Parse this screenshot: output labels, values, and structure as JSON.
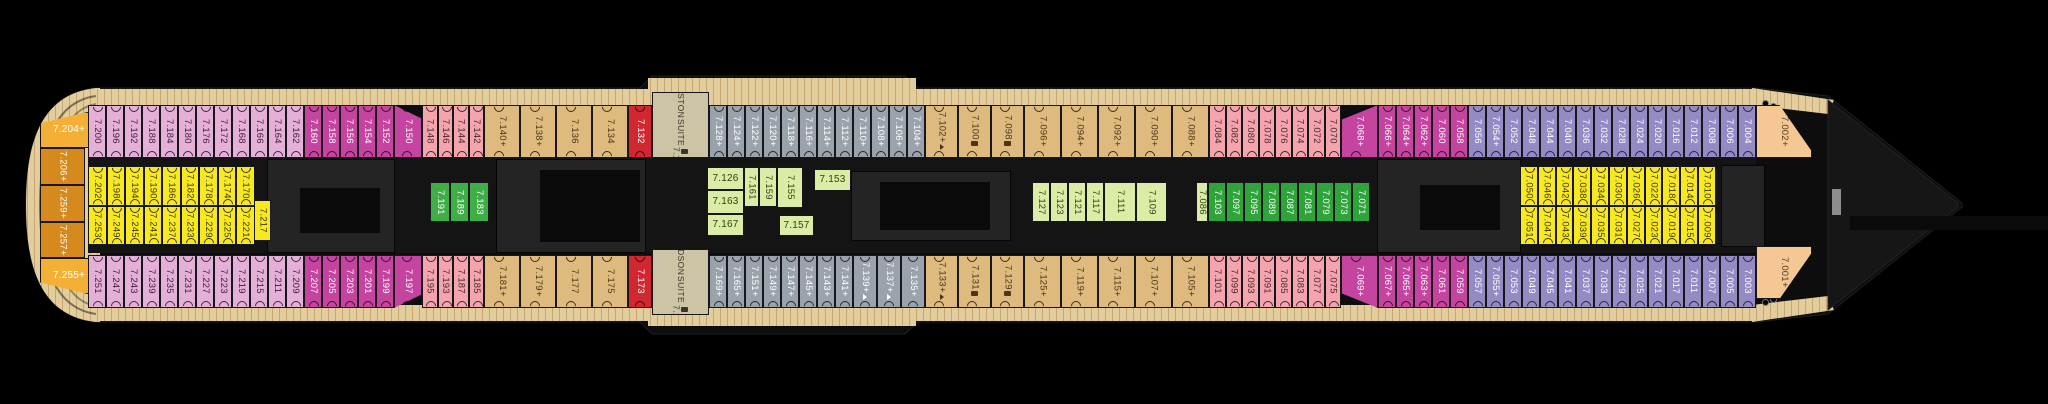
{
  "deck_plan": {
    "deck_number_prefix": "7",
    "suites": [
      "BOSTON SUITE 7.130",
      "HUDSON SUITE 7.171"
    ],
    "icon_legend_names": {
      "p": "plus",
      "s": "sofa-icon",
      "pa": "plus-accessible-icon"
    }
  },
  "colors": {
    "pink": "#e4b0d7",
    "magenta": "#c5449f",
    "salmon": "#f3a4ac",
    "tan": "#dfba7e",
    "red": "#d02730",
    "gray": "#9aa2ab",
    "suite": "#cdc4a6",
    "lightgreen": "#daeca6",
    "green": "#3fae47",
    "darkgreen": "#2ea43b",
    "purple": "#948bc5",
    "yellow": "#f7e821",
    "amber": "#f3b034",
    "orange": "#d68a1d",
    "bowtan": "#f5c795",
    "deck": "#e3cd9c"
  },
  "sections": [
    {
      "c": "amber",
      "x": 40,
      "y": 112,
      "w": 58,
      "h": 36,
      "o": "h",
      "clip": "sternT",
      "cabins": [
        [
          "7.204",
          "p"
        ]
      ]
    },
    {
      "c": "orange",
      "x": 40,
      "y": 148,
      "w": 45,
      "h": 37,
      "o": "v",
      "cabins": [
        [
          "7.206",
          "p"
        ]
      ]
    },
    {
      "c": "orange",
      "x": 40,
      "y": 185,
      "w": 45,
      "h": 37,
      "o": "v",
      "cabins": [
        [
          "7.259",
          "p"
        ]
      ]
    },
    {
      "c": "orange",
      "x": 40,
      "y": 222,
      "w": 45,
      "h": 36,
      "o": "v",
      "cabins": [
        [
          "7.257",
          "p"
        ]
      ]
    },
    {
      "c": "amber",
      "x": 40,
      "y": 258,
      "w": 58,
      "h": 36,
      "o": "h",
      "clip": "sternB",
      "cabins": [
        [
          "7.255",
          "p"
        ]
      ]
    },
    {
      "c": "pink",
      "r": "t",
      "x": 88,
      "w": 18,
      "cabins": [
        [
          "7.200"
        ],
        [
          "7.196"
        ],
        [
          "7.192"
        ],
        [
          "7.188"
        ],
        [
          "7.184"
        ],
        [
          "7.180"
        ],
        [
          "7.176"
        ],
        [
          "7.172"
        ],
        [
          "7.168"
        ],
        [
          "7.166"
        ],
        [
          "7.164"
        ],
        [
          "7.162"
        ]
      ]
    },
    {
      "c": "magenta",
      "r": "t",
      "x": 304,
      "w": 18,
      "cabins": [
        [
          "7.160"
        ],
        [
          "7.158"
        ],
        [
          "7.156"
        ],
        [
          "7.154"
        ],
        [
          "7.152"
        ]
      ]
    },
    {
      "c": "magenta",
      "r": "t",
      "x": 394,
      "w": 28,
      "clip": "slantTR",
      "cabins": [
        [
          "7.150"
        ]
      ]
    },
    {
      "c": "salmon",
      "r": "t",
      "x": 422,
      "w": 15.5,
      "cabins": [
        [
          "7.148"
        ],
        [
          "7.146"
        ],
        [
          "7.144"
        ],
        [
          "7.142"
        ]
      ]
    },
    {
      "c": "tan",
      "r": "t",
      "x": 484,
      "w": 36,
      "cabins": [
        [
          "7.140",
          "p"
        ],
        [
          "7.138",
          "p"
        ],
        [
          "7.136"
        ],
        [
          "7.134"
        ]
      ]
    },
    {
      "c": "red",
      "r": "t",
      "x": 628,
      "w": 24,
      "cabins": [
        [
          "7.132"
        ]
      ]
    },
    {
      "c": "suite",
      "x": 652,
      "y": 92,
      "w": 57,
      "h": 66,
      "o": "suite",
      "name": [
        "BOSTON",
        "SUITE"
      ],
      "cabins": [
        [
          "7.130",
          "s"
        ]
      ]
    },
    {
      "c": "gray",
      "r": "t",
      "x": 709,
      "w": 18,
      "cabins": [
        [
          "7.128",
          "p"
        ],
        [
          "7.124",
          "p"
        ],
        [
          "7.122",
          "p"
        ],
        [
          "7.120",
          "p"
        ],
        [
          "7.118",
          "p"
        ],
        [
          "7.116",
          "p"
        ],
        [
          "7.114",
          "p"
        ],
        [
          "7.112",
          "p"
        ],
        [
          "7.110",
          "p"
        ],
        [
          "7.108",
          "p"
        ],
        [
          "7.106",
          "p"
        ],
        [
          "7.104",
          "p"
        ]
      ]
    },
    {
      "c": "tan",
      "r": "t",
      "x": 925,
      "w": 33,
      "cabins": [
        [
          "7.102",
          "pa"
        ],
        [
          "7.100",
          "s"
        ],
        [
          "7.098",
          "s"
        ]
      ]
    },
    {
      "c": "tan",
      "r": "t",
      "x": 1024,
      "w": 37,
      "cabins": [
        [
          "7.096",
          "p"
        ],
        [
          "7.094",
          "p"
        ],
        [
          "7.092",
          "p"
        ],
        [
          "7.090",
          "p"
        ],
        [
          "7.088",
          "p"
        ]
      ]
    },
    {
      "c": "salmon",
      "r": "t",
      "x": 1209,
      "w": 16.5,
      "cabins": [
        [
          "7.084"
        ],
        [
          "7.082"
        ],
        [
          "7.080"
        ],
        [
          "7.078"
        ],
        [
          "7.076"
        ],
        [
          "7.074"
        ],
        [
          "7.072"
        ],
        [
          "7.070"
        ]
      ]
    },
    {
      "c": "magenta",
      "r": "t",
      "x": 1341,
      "w": 37,
      "clip": "slantTL",
      "cabins": [
        [
          "7.068",
          "p"
        ]
      ]
    },
    {
      "c": "magenta",
      "r": "t",
      "x": 1378,
      "w": 18,
      "cabins": [
        [
          "7.066",
          "p"
        ],
        [
          "7.064",
          "p"
        ],
        [
          "7.062",
          "p"
        ],
        [
          "7.060"
        ],
        [
          "7.058"
        ]
      ]
    },
    {
      "c": "purple",
      "r": "t",
      "x": 1468,
      "w": 18,
      "cabins": [
        [
          "7.056"
        ],
        [
          "7.054",
          "p"
        ],
        [
          "7.052"
        ],
        [
          "7.048"
        ],
        [
          "7.044"
        ],
        [
          "7.040"
        ],
        [
          "7.036"
        ],
        [
          "7.032"
        ],
        [
          "7.028"
        ],
        [
          "7.024"
        ],
        [
          "7.020"
        ],
        [
          "7.016"
        ],
        [
          "7.012"
        ],
        [
          "7.008"
        ],
        [
          "7.006"
        ],
        [
          "7.004"
        ]
      ]
    },
    {
      "c": "bowtan",
      "x": 1756,
      "y": 105,
      "w": 56,
      "h": 53,
      "o": "v",
      "clip": "bowT",
      "cabins": [
        [
          "7.002",
          "p"
        ]
      ]
    },
    {
      "c": "pink",
      "r": "b",
      "x": 88,
      "w": 18,
      "cabins": [
        [
          "7.251"
        ],
        [
          "7.247"
        ],
        [
          "7.243"
        ],
        [
          "7.239"
        ],
        [
          "7.235"
        ],
        [
          "7.231"
        ],
        [
          "7.227"
        ],
        [
          "7.223"
        ],
        [
          "7.219"
        ],
        [
          "7.215"
        ],
        [
          "7.211"
        ],
        [
          "7.209"
        ]
      ]
    },
    {
      "c": "magenta",
      "r": "b",
      "x": 304,
      "w": 18,
      "cabins": [
        [
          "7.207"
        ],
        [
          "7.205"
        ],
        [
          "7.203"
        ],
        [
          "7.201"
        ],
        [
          "7.199"
        ]
      ]
    },
    {
      "c": "magenta",
      "r": "b",
      "x": 394,
      "w": 28,
      "clip": "slantBR",
      "cabins": [
        [
          "7.197"
        ]
      ]
    },
    {
      "c": "salmon",
      "r": "b",
      "x": 422,
      "w": 15.5,
      "cabins": [
        [
          "7.195"
        ],
        [
          "7.193"
        ],
        [
          "7.187"
        ],
        [
          "7.185"
        ]
      ]
    },
    {
      "c": "tan",
      "r": "b",
      "x": 484,
      "w": 36,
      "cabins": [
        [
          "7.181",
          "p"
        ],
        [
          "7.179",
          "p"
        ],
        [
          "7.177"
        ],
        [
          "7.175"
        ]
      ]
    },
    {
      "c": "red",
      "r": "b",
      "x": 628,
      "w": 24,
      "cabins": [
        [
          "7.173"
        ]
      ]
    },
    {
      "c": "suite",
      "x": 652,
      "y": 249,
      "w": 57,
      "h": 66,
      "o": "suite",
      "name": [
        "HUDSON",
        "SUITE"
      ],
      "cabins": [
        [
          "7.171",
          "s"
        ]
      ]
    },
    {
      "c": "gray",
      "r": "b",
      "x": 709,
      "w": 18,
      "cabins": [
        [
          "7.169",
          "p"
        ],
        [
          "7.165",
          "p"
        ],
        [
          "7.151",
          "p"
        ],
        [
          "7.149",
          "p"
        ],
        [
          "7.147",
          "p"
        ],
        [
          "7.145",
          "p"
        ],
        [
          "7.143",
          "p"
        ],
        [
          "7.141",
          "p"
        ],
        [
          "7.139",
          "pa",
          24
        ],
        [
          "7.137",
          "pa",
          24
        ],
        [
          "7.135",
          "p",
          24
        ]
      ]
    },
    {
      "c": "tan",
      "r": "b",
      "x": 925,
      "w": 33,
      "cabins": [
        [
          "7.133",
          "pa"
        ],
        [
          "7.131",
          "s"
        ],
        [
          "7.129",
          "s"
        ]
      ]
    },
    {
      "c": "tan",
      "r": "b",
      "x": 1024,
      "w": 37,
      "cabins": [
        [
          "7.125",
          "p"
        ],
        [
          "7.119",
          "p"
        ],
        [
          "7.115",
          "p"
        ],
        [
          "7.107",
          "p"
        ],
        [
          "7.105",
          "p"
        ]
      ]
    },
    {
      "c": "salmon",
      "r": "b",
      "x": 1209,
      "w": 16.5,
      "cabins": [
        [
          "7.101"
        ],
        [
          "7.099"
        ],
        [
          "7.093"
        ],
        [
          "7.091"
        ],
        [
          "7.085"
        ],
        [
          "7.083"
        ],
        [
          "7.077"
        ],
        [
          "7.075"
        ]
      ]
    },
    {
      "c": "magenta",
      "r": "b",
      "x": 1341,
      "w": 37,
      "clip": "slantBL",
      "cabins": [
        [
          "7.069",
          "p"
        ]
      ]
    },
    {
      "c": "magenta",
      "r": "b",
      "x": 1378,
      "w": 18,
      "cabins": [
        [
          "7.067",
          "p"
        ],
        [
          "7.065",
          "p"
        ],
        [
          "7.063",
          "p"
        ],
        [
          "7.061"
        ],
        [
          "7.059"
        ]
      ]
    },
    {
      "c": "purple",
      "r": "b",
      "x": 1468,
      "w": 18,
      "cabins": [
        [
          "7.057"
        ],
        [
          "7.055",
          "p"
        ],
        [
          "7.053"
        ],
        [
          "7.049"
        ],
        [
          "7.045"
        ],
        [
          "7.041"
        ],
        [
          "7.037"
        ],
        [
          "7.033"
        ],
        [
          "7.029"
        ],
        [
          "7.025"
        ],
        [
          "7.021"
        ],
        [
          "7.017"
        ],
        [
          "7.011"
        ],
        [
          "7.007"
        ],
        [
          "7.005"
        ],
        [
          "7.003"
        ]
      ]
    },
    {
      "c": "bowtan",
      "x": 1756,
      "y": 246,
      "w": 56,
      "h": 53,
      "o": "v",
      "clip": "bowB",
      "cabins": [
        [
          "7.001",
          "p"
        ]
      ]
    },
    {
      "c": "yellow",
      "r": "mt",
      "x": 88,
      "w": 18.5,
      "cabins": [
        [
          "7.202"
        ],
        [
          "7.198"
        ],
        [
          "7.194"
        ],
        [
          "7.190"
        ],
        [
          "7.186"
        ],
        [
          "7.182"
        ],
        [
          "7.178"
        ],
        [
          "7.174"
        ],
        [
          "7.170"
        ]
      ]
    },
    {
      "c": "yellow",
      "r": "mb",
      "x": 88,
      "w": 18.5,
      "cabins": [
        [
          "7.253"
        ],
        [
          "7.249"
        ],
        [
          "7.245"
        ],
        [
          "7.241"
        ],
        [
          "7.237"
        ],
        [
          "7.233"
        ],
        [
          "7.229"
        ],
        [
          "7.225"
        ],
        [
          "7.221"
        ]
      ]
    },
    {
      "c": "yellow",
      "x": 254,
      "y": 200,
      "w": 17,
      "h": 41,
      "o": "v",
      "cabins": [
        [
          "7.217"
        ]
      ]
    },
    {
      "c": "green",
      "x": 430,
      "y": 182,
      "w": 20,
      "h": 40,
      "o": "v",
      "cabins": [
        [
          "7.191",
          null,
          20
        ],
        [
          "7.189",
          null,
          19
        ],
        [
          "7.183",
          null,
          20
        ]
      ]
    },
    {
      "c": "lightgreen",
      "x": 707,
      "y": 167,
      "w": 37,
      "h": 23,
      "o": "h",
      "cabins": [
        [
          "7.126"
        ]
      ]
    },
    {
      "c": "lightgreen",
      "x": 707,
      "y": 190,
      "w": 37,
      "h": 24,
      "o": "h",
      "cabins": [
        [
          "7.163"
        ]
      ]
    },
    {
      "c": "lightgreen",
      "x": 707,
      "y": 214,
      "w": 37,
      "h": 22,
      "o": "h",
      "cabins": [
        [
          "7.167"
        ]
      ]
    },
    {
      "c": "lightgreen",
      "x": 744,
      "y": 167,
      "w": 15,
      "h": 40,
      "o": "v",
      "cabins": [
        [
          "7.161"
        ]
      ]
    },
    {
      "c": "lightgreen",
      "x": 759,
      "y": 167,
      "w": 18,
      "h": 40,
      "o": "v",
      "cabins": [
        [
          "7.159"
        ]
      ]
    },
    {
      "c": "lightgreen",
      "x": 777,
      "y": 167,
      "w": 26,
      "h": 41,
      "o": "v",
      "cabins": [
        [
          "7.155"
        ]
      ]
    },
    {
      "c": "lightgreen",
      "x": 814,
      "y": 169,
      "w": 37,
      "h": 22,
      "o": "h",
      "cabins": [
        [
          "7.153"
        ]
      ]
    },
    {
      "c": "lightgreen",
      "x": 779,
      "y": 215,
      "w": 35,
      "h": 21,
      "o": "h",
      "cabins": [
        [
          "7.157"
        ]
      ]
    },
    {
      "c": "lightgreen",
      "x": 1032,
      "y": 182,
      "w": 18,
      "h": 40,
      "o": "v",
      "cabins": [
        [
          "7.127"
        ],
        [
          "7.123"
        ],
        [
          "7.121"
        ],
        [
          "7.117"
        ],
        [
          "7.111",
          null,
          32
        ],
        [
          "7.109",
          null,
          31
        ]
      ]
    },
    {
      "c": "lightgreen",
      "x": 1196,
      "y": 182,
      "w": 12,
      "h": 40,
      "o": "v",
      "cabins": [
        [
          "7.086"
        ]
      ]
    },
    {
      "c": "darkgreen",
      "x": 1208,
      "y": 182,
      "w": 18,
      "h": 40,
      "o": "v",
      "cabins": [
        [
          "7.103"
        ],
        [
          "7.097"
        ],
        [
          "7.095"
        ],
        [
          "7.089"
        ],
        [
          "7.087"
        ],
        [
          "7.081"
        ],
        [
          "7.079"
        ],
        [
          "7.073"
        ],
        [
          "7.071"
        ]
      ]
    },
    {
      "c": "yellow",
      "r": "mt",
      "x": 1520,
      "w": 17.8,
      "cabins": [
        [
          "7.050"
        ],
        [
          "7.046"
        ],
        [
          "7.042"
        ],
        [
          "7.038"
        ],
        [
          "7.034"
        ],
        [
          "7.030"
        ],
        [
          "7.026"
        ],
        [
          "7.022"
        ],
        [
          "7.018"
        ],
        [
          "7.014"
        ],
        [
          "7.010"
        ]
      ]
    },
    {
      "c": "yellow",
      "r": "mb",
      "x": 1520,
      "w": 17.8,
      "cabins": [
        [
          "7.051"
        ],
        [
          "7.047"
        ],
        [
          "7.043"
        ],
        [
          "7.039"
        ],
        [
          "7.035"
        ],
        [
          "7.031"
        ],
        [
          "7.027"
        ],
        [
          "7.023"
        ],
        [
          "7.019"
        ],
        [
          "7.015"
        ],
        [
          "7.009"
        ]
      ]
    }
  ],
  "structures": [
    {
      "t": "corridor",
      "x": 88,
      "y": 158,
      "w": 1668,
      "h": 95,
      "name": "corridor-band"
    },
    {
      "t": "box",
      "x": 268,
      "y": 160,
      "w": 126,
      "h": 92,
      "name": "stairwell-block"
    },
    {
      "t": "inner",
      "x": 300,
      "y": 188,
      "w": 80,
      "h": 45,
      "name": "stairwell-core"
    },
    {
      "t": "box",
      "x": 497,
      "y": 160,
      "w": 148,
      "h": 92,
      "name": "stairwell-block"
    },
    {
      "t": "inner",
      "x": 540,
      "y": 170,
      "w": 100,
      "h": 72,
      "name": "stairwell-core"
    },
    {
      "t": "box",
      "x": 852,
      "y": 172,
      "w": 158,
      "h": 68,
      "name": "stairwell-block"
    },
    {
      "t": "inner",
      "x": 880,
      "y": 182,
      "w": 110,
      "h": 48,
      "name": "stairwell-core"
    },
    {
      "t": "box",
      "x": 1378,
      "y": 160,
      "w": 142,
      "h": 92,
      "name": "stairwell-block"
    },
    {
      "t": "inner",
      "x": 1420,
      "y": 185,
      "w": 80,
      "h": 45,
      "name": "stairwell-core"
    },
    {
      "t": "box",
      "x": 1722,
      "y": 166,
      "w": 42,
      "h": 80,
      "name": "stairwell-block"
    },
    {
      "t": "pod",
      "x": 940,
      "y": 283,
      "w": 150,
      "h": 16,
      "name": "deck-structure"
    },
    {
      "t": "gray",
      "x": 1832,
      "y": 189,
      "w": 9,
      "h": 26,
      "name": "bow-fitting"
    },
    {
      "t": "inner",
      "x": 1850,
      "y": 216,
      "w": 198,
      "h": 14,
      "name": "bow-outline-bar"
    },
    {
      "t": "dot",
      "x": 1762,
      "y": 100,
      "w": 5,
      "h": 5,
      "name": "deck-fitting"
    },
    {
      "t": "dot",
      "x": 1770,
      "y": 103,
      "w": 5,
      "h": 5,
      "name": "deck-fitting"
    },
    {
      "t": "dot",
      "x": 1762,
      "y": 299,
      "w": 5,
      "h": 5,
      "name": "deck-fitting"
    },
    {
      "t": "dot",
      "x": 1770,
      "y": 296,
      "w": 5,
      "h": 5,
      "name": "deck-fitting"
    }
  ]
}
